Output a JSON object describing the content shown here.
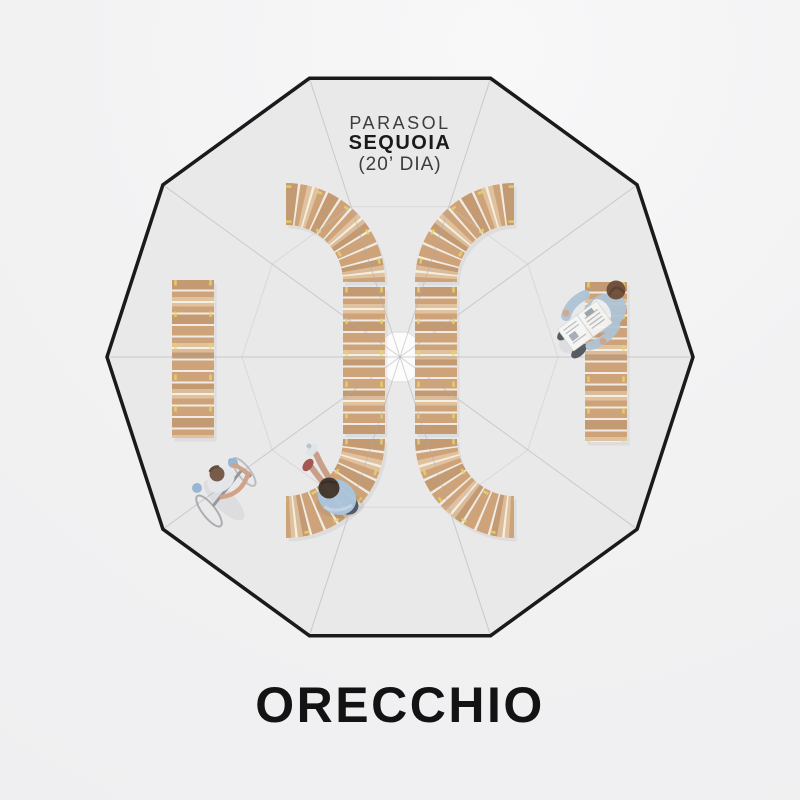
{
  "page": {
    "background": "#f2f2f3"
  },
  "parasol_label": {
    "line1": "PARASOL",
    "line2": "SEQUOIA",
    "line3": "(20’ DIA)"
  },
  "product_title": "ORECCHIO",
  "scene": {
    "view": "top-down plan of a decagonal parasol canopy",
    "canopy_sides": 10,
    "benches": {
      "curved": 2,
      "straight": 2,
      "material": "wood slats"
    },
    "figures": [
      "cyclist",
      "seated-person",
      "newspaper-reader"
    ]
  },
  "colors": {
    "background": "#f2f2f3",
    "canopy_fill": "#e3e3e5",
    "canopy_overlay": "rgba(255,255,255,0.22)",
    "canopy_outline": "#1a1a1a",
    "seam_line": "#ababb0",
    "hub_fill": "#fbfbfc",
    "wood": "#c08a55",
    "wood_gap": "#ece7de",
    "wood_accent": "#dec93f",
    "label_text": "#3d3d3f",
    "label_text_bold": "#1a1a1c",
    "title_text": "#131313"
  }
}
